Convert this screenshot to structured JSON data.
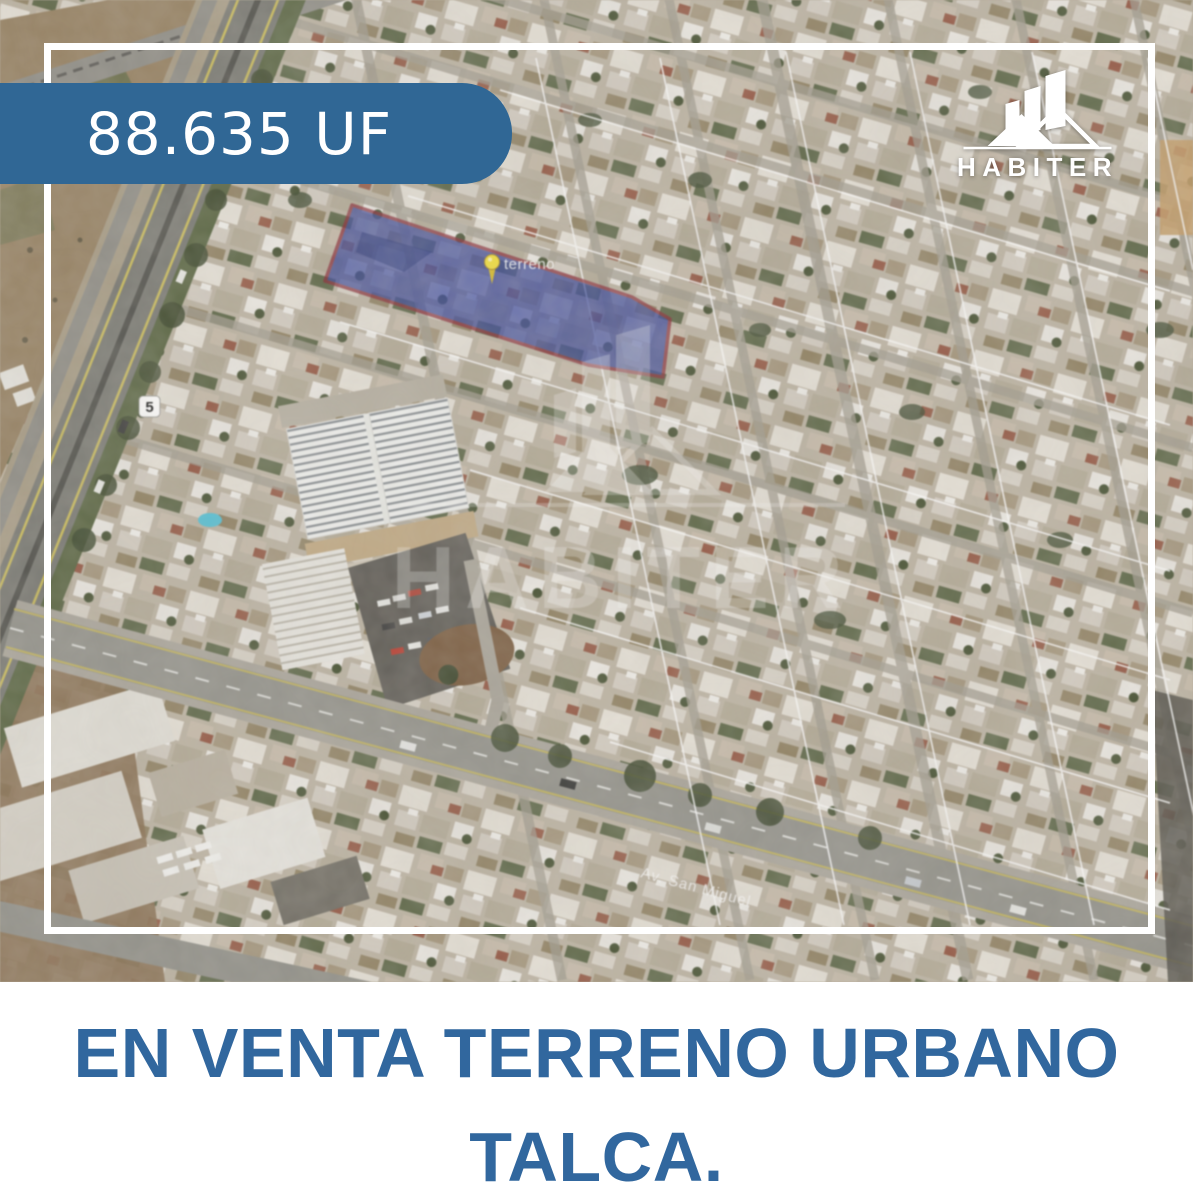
{
  "price_badge": {
    "label": "88.635 UF"
  },
  "brand": {
    "name": "HABITER",
    "logo_icon": "buildings-and-roofs"
  },
  "map": {
    "parcel_label": "terreno",
    "street_label": "Av. San Miguel",
    "route_shield": "5",
    "watermark_text": "HABITER",
    "pin_icon": "yellow-pushpin"
  },
  "caption": {
    "line1": "EN VENTA TERRENO URBANO",
    "line2": "TALCA."
  },
  "colors": {
    "badge_blue": "#306795",
    "caption_blue": "#31679E",
    "parcel_fill": "#2E3FA0",
    "parcel_border": "#8C1F2E",
    "pin_yellow": "#F2DC2E",
    "frame_white": "#FFFFFF"
  }
}
